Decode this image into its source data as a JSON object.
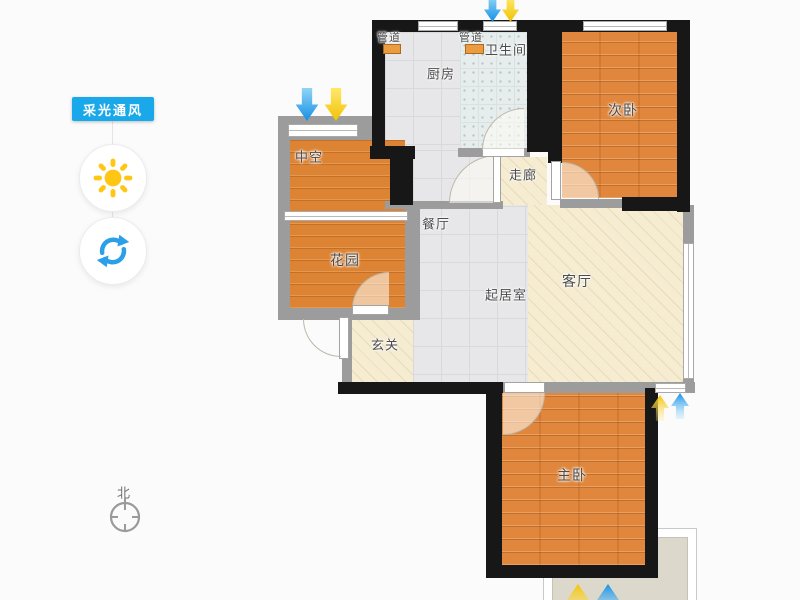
{
  "panel": {
    "title": "采光通风",
    "buttons": [
      {
        "id": "sun",
        "icon": "sun-icon"
      },
      {
        "id": "rotate",
        "icon": "refresh-icon"
      }
    ]
  },
  "compass": {
    "north": "北"
  },
  "plan": {
    "rooms": {
      "duct1": "管道",
      "duct2": "管道",
      "kitchen": "厨房",
      "bathroom": "卫生间",
      "bedroom2": "次卧",
      "void": "中空",
      "corridor": "走廊",
      "dining": "餐厅",
      "garden": "花园",
      "living": "客厅",
      "family": "起居室",
      "foyer": "玄关",
      "master": "主卧"
    }
  },
  "colors": {
    "panel_blue": "#19a9ea",
    "sun_yellow": "#ffc614",
    "refresh_blue": "#2b9fe8",
    "arrow_blue": "#1a95e8",
    "arrow_yellow": "#f6c50a",
    "wood_floor": "#e0873d",
    "beige_floor": "#f5ecd1",
    "tile_floor": "#e7e7e9",
    "wall_black": "#171717",
    "wall_gray": "#9c9c9c"
  }
}
